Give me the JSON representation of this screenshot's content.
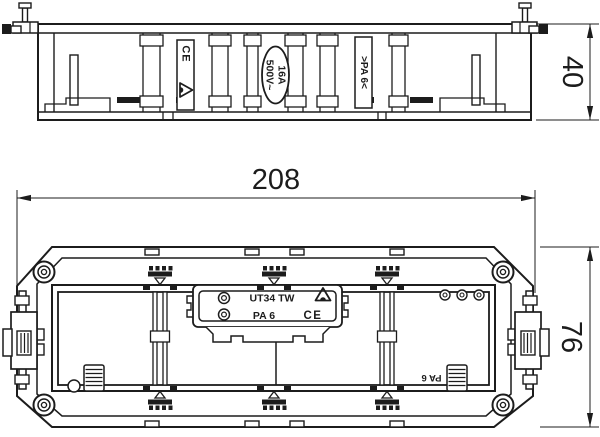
{
  "side_view": {
    "ce_mark": "CE",
    "rating_voltage": "500V~",
    "rating_current": "16A",
    "material_label": ">PA 6<",
    "dim_height": "40"
  },
  "plan_view": {
    "dim_width": "208",
    "dim_depth": "76",
    "nameplate": {
      "product": "UT34 TW",
      "material": "PA 6",
      "ce_mark": "CE"
    },
    "material_marking": "PA 6"
  },
  "colors": {
    "line": "#1c1c1c",
    "background": "#ffffff"
  }
}
